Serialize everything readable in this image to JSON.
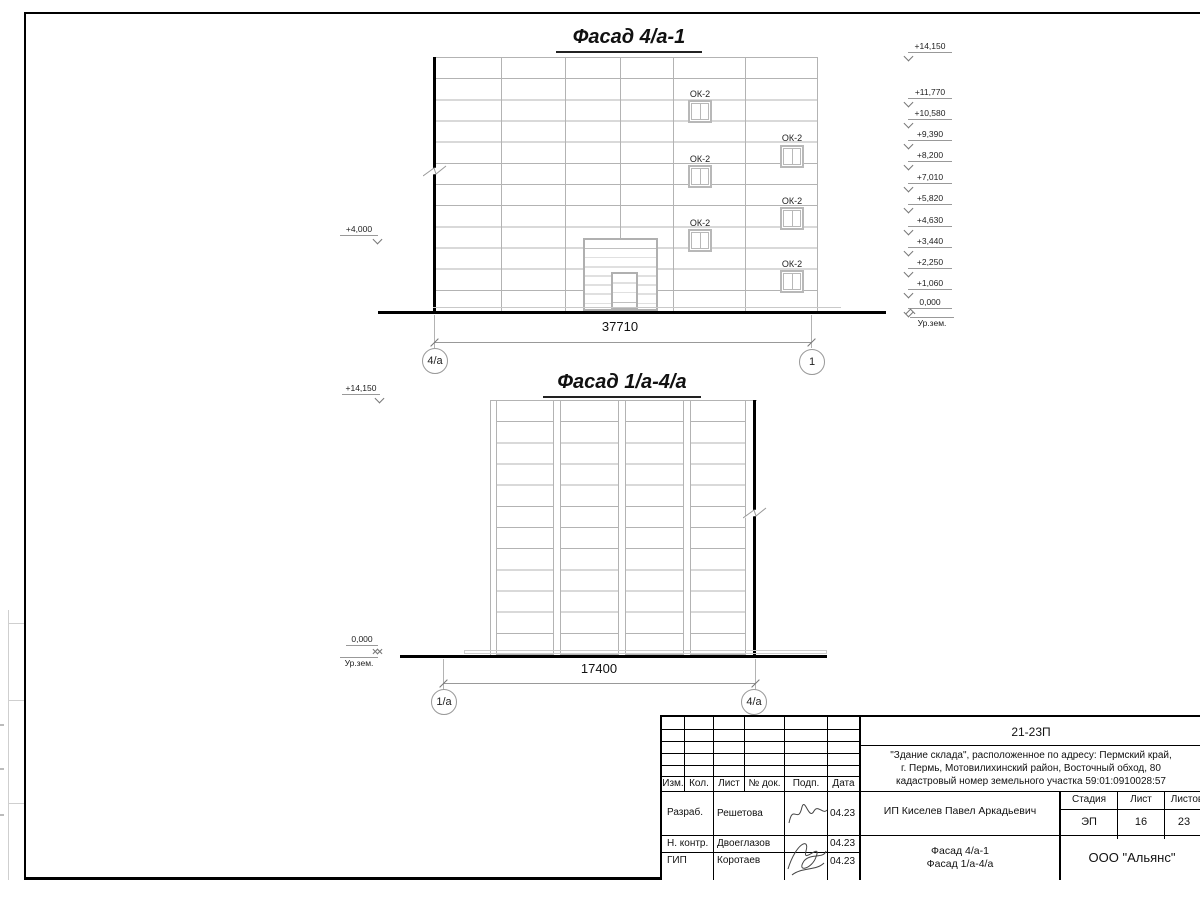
{
  "sheet": {
    "facade1": {
      "title": "Фасад 4/а-1",
      "dimension": "37710",
      "axis_left": "4/а",
      "axis_right": "1",
      "level_left": "+4,000",
      "levels": [
        "+14,150",
        "+11,770",
        "+10,580",
        "+9,390",
        "+8,200",
        "+7,010",
        "+5,820",
        "+4,630",
        "+3,440",
        "+2,250",
        "+1,060",
        "0,000"
      ],
      "ground_label": "Ур.зем.",
      "window_labels": [
        "ОК-2",
        "ОК-2",
        "ОК-2",
        "ОК-2",
        "ОК-2",
        "ОК-2"
      ]
    },
    "facade2": {
      "title": "Фасад 1/а-4/а",
      "dimension": "17400",
      "axis_left": "1/а",
      "axis_right": "4/а",
      "level_top": "+14,150",
      "level_zero": "0,000",
      "ground_label": "Ур.зем."
    },
    "titleblock": {
      "code": "21-23П",
      "description": [
        "\"Здание склада\", расположенное по адресу: Пермский край,",
        "г. Пермь, Мотовилихинский район, Восточный обход, 80",
        "кадастровый номер земельного участка 59:01:0910028:57"
      ],
      "columns": {
        "izm": "Изм.",
        "kol": "Кол.",
        "list": "Лист",
        "ndok": "№ док.",
        "podp": "Подп.",
        "data": "Дата"
      },
      "rows": [
        {
          "role": "Разраб.",
          "name": "Решетова",
          "date": "04.23"
        },
        {
          "role": "Н. контр.",
          "name": "Двоеглазов",
          "date": "04.23"
        },
        {
          "role": "ГИП",
          "name": "Коротаев",
          "date": "04.23"
        }
      ],
      "client": "ИП Киселев Павел Аркадьевич",
      "stage_label": "Стадия",
      "sheet_label": "Лист",
      "sheets_label": "Листов",
      "stage": "ЭП",
      "sheet_no": "16",
      "sheets_total": "23",
      "doc_name": [
        "Фасад 4/а-1",
        "Фасад 1/а-4/а"
      ],
      "company": "ООО \"Альянс\""
    }
  }
}
